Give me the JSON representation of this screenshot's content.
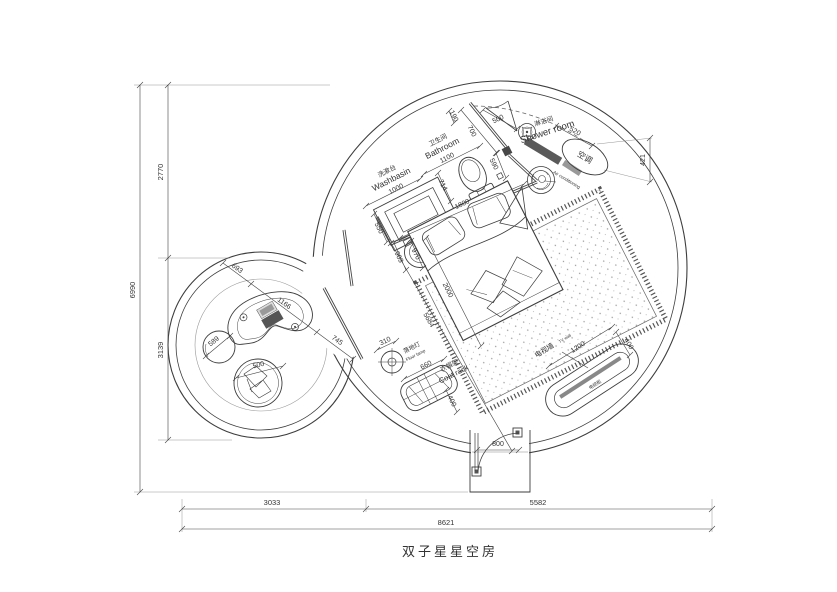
{
  "drawing": {
    "title": "双子星星空房",
    "labels": {
      "washbasin_cn": "洗漱台",
      "washbasin_en": "Washbasin",
      "bathroom_cn": "卫生间",
      "bathroom_en": "Bathroom",
      "shower_cn": "淋浴间",
      "shower_en": "Shower room",
      "ac_cn": "空调",
      "ac_en": "Air conditioning",
      "tv_wall_cn": "电视墙",
      "tv_wall_en": "TV wall",
      "tv_cabinet_cn": "电视柜",
      "coat_rack_cn": "衣帽架",
      "coat_rack_en": "Coat rack",
      "floor_lamp_cn": "落地灯",
      "floor_lamp_en": "Floor lamp"
    },
    "dims": {
      "overall_height": "6990",
      "height_top": "2770",
      "height_mid": "3139",
      "overall_width": "8621",
      "width_left": "3033",
      "width_right": "5582",
      "washbasin": "1000",
      "bathroom": "1100",
      "top_gap": "190",
      "bath_wall": "700",
      "shower_door": "500",
      "column": "590",
      "toilet": "714",
      "head_wall": "1800",
      "basin_side": "550",
      "sink_a": "903",
      "sink_b": "970",
      "bed": "2000",
      "room_diag": "5684",
      "ac_width": "520",
      "ac_depth": "421",
      "tv_length": "1200",
      "tv_depth": "400",
      "coat_length": "660",
      "coat_depth": "400",
      "lamp": "310",
      "entry_door": "800",
      "desk_a": "693",
      "desk_b": "1166",
      "desk_c": "745",
      "pouf": "589",
      "beanbag": "500"
    }
  }
}
